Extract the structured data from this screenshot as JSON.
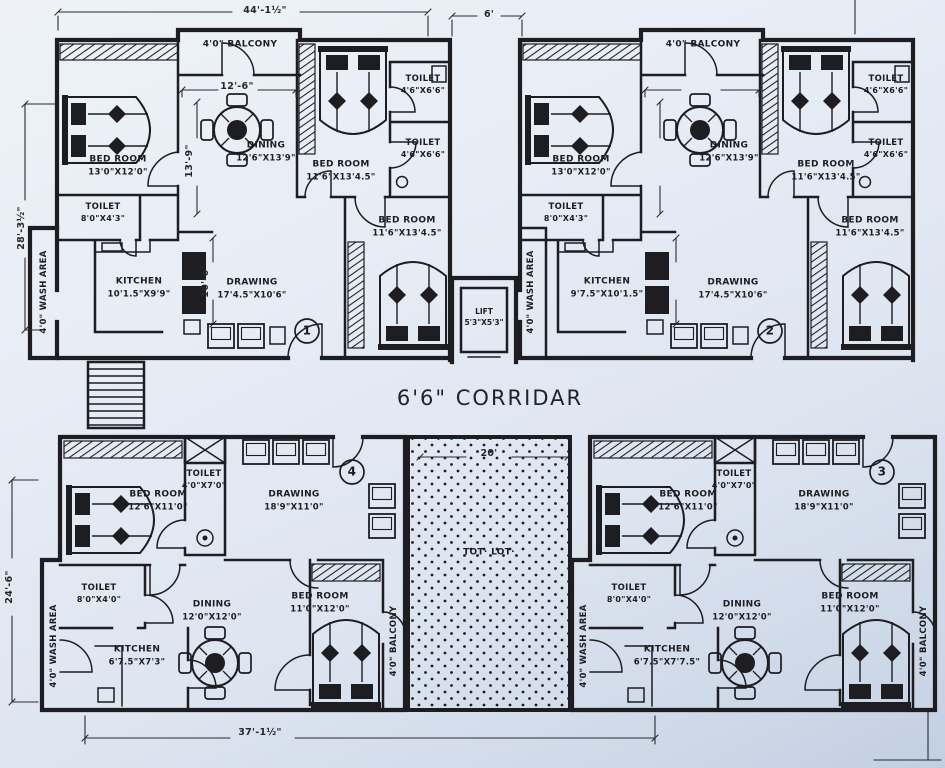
{
  "colors": {
    "paper": "#e7ecf5",
    "ink": "#1d1d22"
  },
  "dims": {
    "top_width": "44'-1½\"",
    "top_gap": "6'",
    "left_upper": "28'-3½\"",
    "left_lower": "24'-6\"",
    "bottom_width": "37'-1½\"",
    "totlot_width": "20'",
    "dining_width": "12'-6\"",
    "dining_depth": "13'-9\"",
    "drawing_depth": "10'-6\""
  },
  "corridor": {
    "label": "6'6\" CORRIDAR"
  },
  "lift": {
    "name": "LIFT",
    "size": "5'3\"X5'3\""
  },
  "totlot": {
    "label": "TOT· LOT·"
  },
  "unit1": {
    "number": "1",
    "balcony": "4'0\" BALCONY",
    "wash": "4'0\" WASH AREA",
    "bed1": {
      "n": "BED ROOM",
      "s": "13'0\"X12'0\""
    },
    "dining": {
      "n": "DINING",
      "s": "12'6\"X13'9\""
    },
    "bed2": {
      "n": "BED ROOM",
      "s": "11'6\"X13'4.5\""
    },
    "toilet_top": {
      "n": "TOILET",
      "s": "4'6\"X6'6\""
    },
    "toilet_mid": {
      "n": "TOILET",
      "s": "4'6\"X6'6\""
    },
    "bed3": {
      "n": "BED ROOM",
      "s": "11'6\"X13'4.5\""
    },
    "toilet_small": {
      "n": "TOILET",
      "s": "8'0\"X4'3\""
    },
    "kitchen": {
      "n": "KITCHEN",
      "s": "10'1.5\"X9'9\""
    },
    "drawing": {
      "n": "DRAWING",
      "s": "17'4.5\"X10'6\""
    }
  },
  "unit2": {
    "number": "2",
    "balcony": "4'0\" BALCONY",
    "wash": "4'0\" WASH AREA",
    "bed1": {
      "n": "BED ROOM",
      "s": "13'0\"X12'0\""
    },
    "dining": {
      "n": "DINING",
      "s": "12'6\"X13'9\""
    },
    "bed2": {
      "n": "BED ROOM",
      "s": "11'6\"X13'4.5\""
    },
    "toilet_top": {
      "n": "TOILET",
      "s": "4'6\"X6'6\""
    },
    "toilet_mid": {
      "n": "TOILET",
      "s": "4'6\"X6'6\""
    },
    "bed3": {
      "n": "BED ROOM",
      "s": "11'6\"X13'4.5\""
    },
    "toilet_small": {
      "n": "TOILET",
      "s": "8'0\"X4'3\""
    },
    "kitchen": {
      "n": "KITCHEN",
      "s": "9'7.5\"X10'1.5\""
    },
    "drawing": {
      "n": "DRAWING",
      "s": "17'4.5\"X10'6\""
    }
  },
  "unit4": {
    "number": "4",
    "balcony": "4'0\" BALCONY",
    "wash": "4'0\" WASH AREA",
    "bed1": {
      "n": "BED ROOM",
      "s": "12'6\"X11'0\""
    },
    "toilet_top": {
      "n": "TOILET",
      "s": "4'0\"X7'0\""
    },
    "drawing": {
      "n": "DRAWING",
      "s": "18'9\"X11'0\""
    },
    "toilet_small": {
      "n": "TOILET",
      "s": "8'0\"X4'0\""
    },
    "dining": {
      "n": "DINING",
      "s": "12'0\"X12'0\""
    },
    "kitchen": {
      "n": "KITCHEN",
      "s": "6'7.5\"X7'3\""
    },
    "bed2": {
      "n": "BED ROOM",
      "s": "11'0\"X12'0\""
    }
  },
  "unit3": {
    "number": "3",
    "balcony": "4'0\" BALCONY",
    "wash": "4'0\" WASH AREA",
    "bed1": {
      "n": "BED ROOM",
      "s": "12'6\"X11'0\""
    },
    "toilet_top": {
      "n": "TOILET",
      "s": "4'0\"X7'0\""
    },
    "drawing": {
      "n": "DRAWING",
      "s": "18'9\"X11'0\""
    },
    "toilet_small": {
      "n": "TOILET",
      "s": "8'0\"X4'0\""
    },
    "dining": {
      "n": "DINING",
      "s": "12'0\"X12'0\""
    },
    "kitchen": {
      "n": "KITCHEN",
      "s": "6'7.5\"X7'7.5\""
    },
    "bed2": {
      "n": "BED ROOM",
      "s": "11'0\"X12'0\""
    }
  }
}
